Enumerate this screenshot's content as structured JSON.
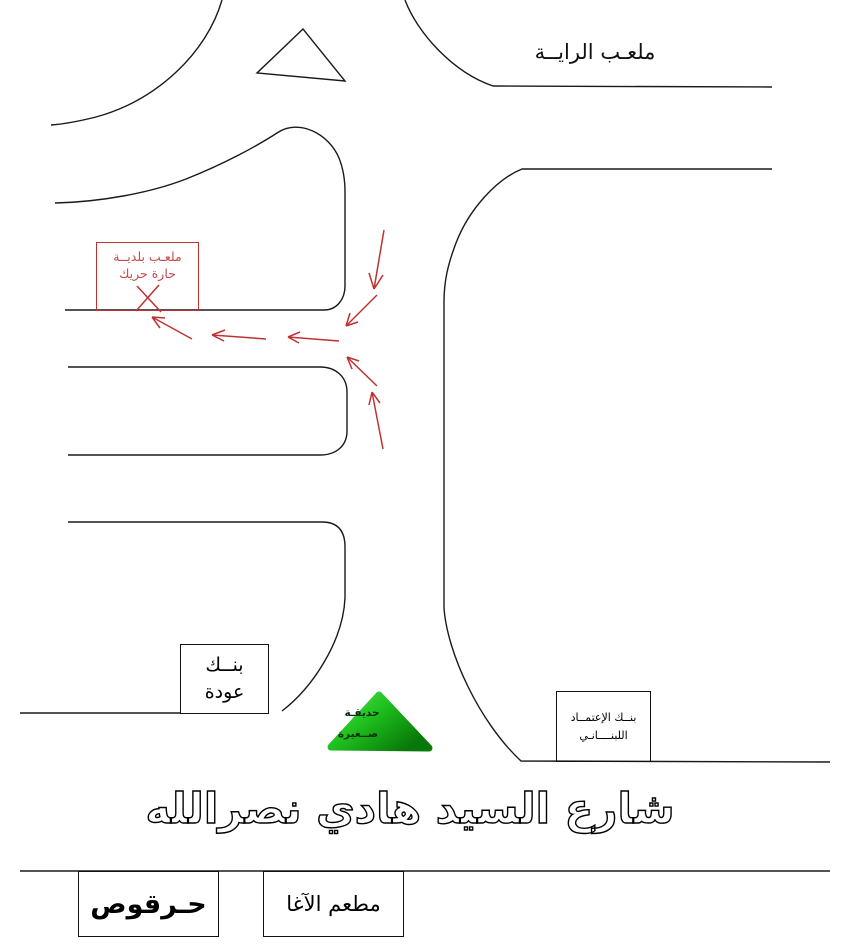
{
  "colors": {
    "line_black": "#1a1a1a",
    "route_red": "#c03232",
    "garden_green_light": "#5ae05a",
    "garden_green_dark": "#087808"
  },
  "labels": {
    "raya_stadium": "ملعـب الرايــة",
    "municipal_stadium": {
      "line1": "ملعـب بلديــة",
      "line2": "حارة حريك"
    },
    "bank_audi": {
      "line1": "بنــك",
      "line2": "عودة"
    },
    "credit_bank": {
      "line1": "بنــك الإعتمــاد",
      "line2": "اللبنــــانـي"
    },
    "garden": {
      "line1": "حديقـة",
      "line2": "صــغيرة"
    },
    "street_name": "شارع السيد هادي نصرالله",
    "harkous": "حـرقوص",
    "agha_restaurant": "مطعم الآغا"
  }
}
